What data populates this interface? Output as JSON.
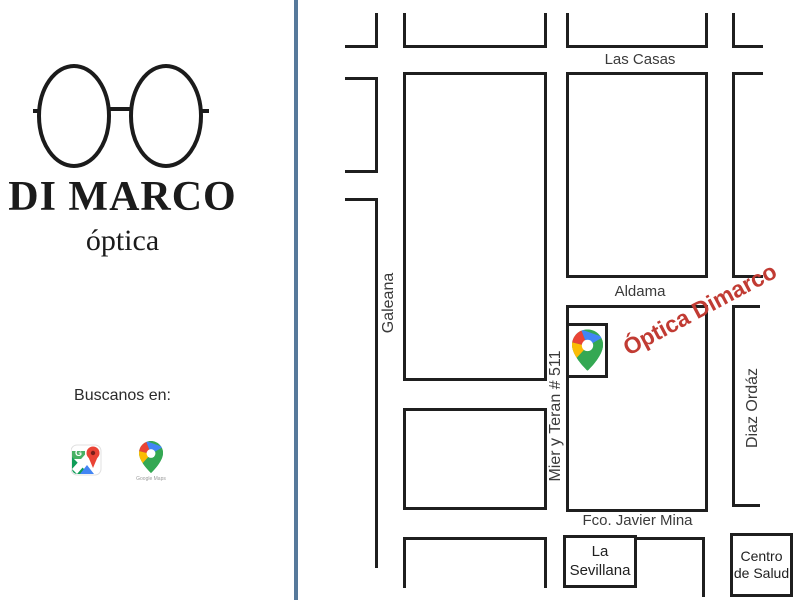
{
  "branding": {
    "name": "DI MARCO",
    "tagline": "óptica",
    "find_us_label": "Buscanos en:",
    "google_maps_caption": "Google Maps"
  },
  "map": {
    "streets": {
      "las_casas": "Las Casas",
      "aldama": "Aldama",
      "fco_javier_mina": "Fco. Javier Mina",
      "galeana": "Galeana",
      "mier_y_teran": "Mier y Teran # 511",
      "diaz_ordaz": "Diaz Ordáz"
    },
    "highlight_label": "Óptica Dimarco",
    "places": {
      "la_sevillana_line1": "La",
      "la_sevillana_line2": "Sevillana",
      "centro_de_salud_line1": "Centro",
      "centro_de_salud_line2": "de Salud"
    }
  },
  "colors": {
    "divider_blue": "#56799b",
    "map_line": "#1f1f1f",
    "highlight_red": "#c13b33",
    "pin_blue": "#4285F4",
    "pin_green": "#34A853",
    "pin_yellow": "#FBBC04",
    "pin_red": "#EA4335"
  }
}
